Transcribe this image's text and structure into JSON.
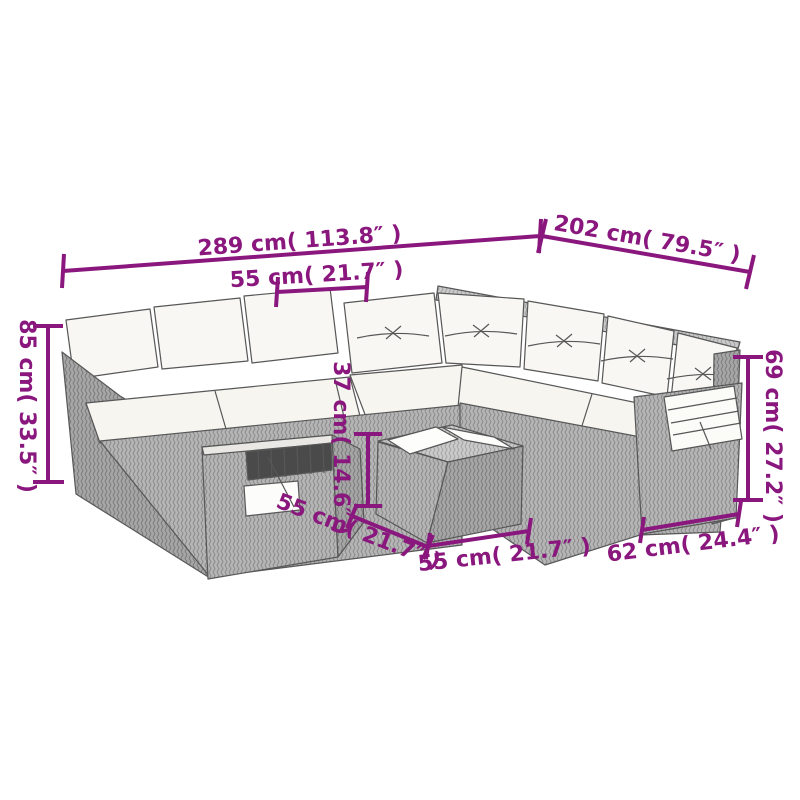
{
  "diagram": {
    "subject": "modular-rattan-corner-sofa-set-with-cushions-and-coffee-table",
    "style": "technical-dimension-line-drawing"
  },
  "colors": {
    "dimension_accent": "#8a177d",
    "line_art": "#575757",
    "wicker_light": "#cacaca",
    "wicker_mid": "#b5b5b5",
    "wicker_dark": "#a6a6a6",
    "cushion": "#f8f7f4",
    "wood_slats": "#4a4a4a"
  },
  "dimensions": {
    "overall_width": "289 cm( 113.8″ )",
    "overall_depth": "202 cm( 79.5″ )",
    "seat_section_width": "55 cm( 21.7″ )",
    "backrest_height": "85 cm( 33.5″ )",
    "table_height": "37 cm( 14.6″ )",
    "table_depth": "55 cm( 21.7″ )",
    "table_width": "55 cm( 21.7″ )",
    "armrest_section_width": "62 cm( 24.4″ )",
    "armrest_height": "69 cm( 27.2″ )"
  }
}
